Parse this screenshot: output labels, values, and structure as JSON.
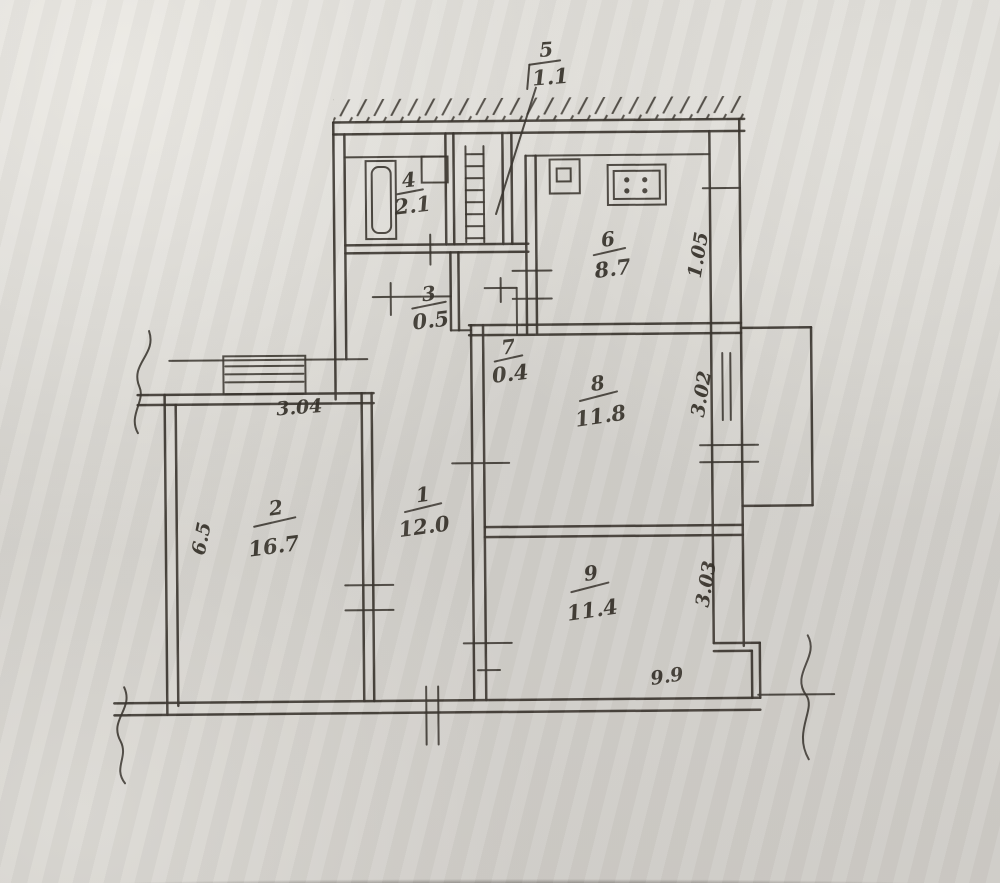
{
  "photo": {
    "description": "scanned hand-drawn apartment floor plan"
  },
  "colors": {
    "paper": "#d5d3ce",
    "ink": "#37322b"
  },
  "rooms": {
    "r1": {
      "number": "1",
      "area": "12.0"
    },
    "r2": {
      "number": "2",
      "area": "16.7"
    },
    "r3": {
      "number": "3",
      "area": "0.5"
    },
    "r4": {
      "number": "4",
      "area": "2.1"
    },
    "r5": {
      "number": "5",
      "area": "1.1"
    },
    "r6": {
      "number": "6",
      "area": "8.7"
    },
    "r7": {
      "number": "7",
      "area": "0.4"
    },
    "r8": {
      "number": "8",
      "area": "11.8"
    },
    "r9": {
      "number": "9",
      "area": "11.4"
    }
  },
  "dimensions": {
    "room2_width_top": "3.04",
    "room2_depth_left": "6.5",
    "kitchen_right": "1.05",
    "room8_right": "3.02",
    "room9_right": "3.03",
    "bottom_width": "9.9"
  }
}
